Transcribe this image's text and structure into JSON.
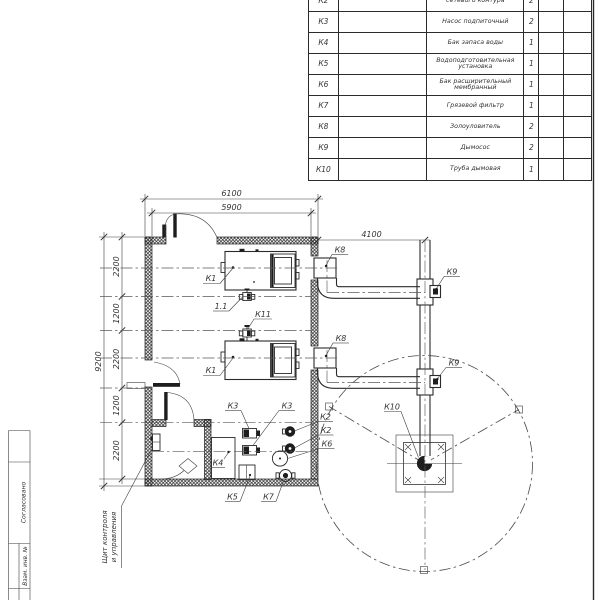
{
  "spec_table": {
    "rows": [
      {
        "pos": "К2",
        "name": "сетевого контура",
        "qty": "2"
      },
      {
        "pos": "К3",
        "name": "Насос подпиточный",
        "qty": "2"
      },
      {
        "pos": "К4",
        "name": "Бак запаса воды",
        "qty": "1"
      },
      {
        "pos": "К5",
        "name": "Водоподготовительная установка",
        "qty": "1"
      },
      {
        "pos": "К6",
        "name": "Бак расширительный мембранный",
        "qty": "1"
      },
      {
        "pos": "К7",
        "name": "Грязевой фильтр",
        "qty": "1"
      },
      {
        "pos": "К8",
        "name": "Золоуловитель",
        "qty": "2"
      },
      {
        "pos": "К9",
        "name": "Дымосос",
        "qty": "2"
      },
      {
        "pos": "К10",
        "name": "Труба дымовая",
        "qty": "1"
      }
    ]
  },
  "dimensions": {
    "top_outer": "6100",
    "top_inner": "5900",
    "flue_offset": "4100",
    "left_overall": "9200",
    "left_chain": [
      "2200",
      "1200",
      "2200",
      "1200",
      "2200"
    ]
  },
  "labels": {
    "k1": "К1",
    "valve_1_1": "1.1",
    "k11": "К11",
    "k2": "К2",
    "k3": "К3",
    "k4": "К4",
    "k5": "К5",
    "k6": "К6",
    "k7": "К7",
    "k8": "К8",
    "k9": "К9",
    "k10": "К10"
  },
  "callout": {
    "line1": "Щит контроля",
    "line2": "и управления"
  },
  "frame": {
    "stamp_agreed": "Согласовано",
    "stamp_inv": "Взам. инв. №"
  },
  "colors": {
    "line": "#2b2b2b",
    "text": "#333333",
    "background": "#ffffff"
  }
}
